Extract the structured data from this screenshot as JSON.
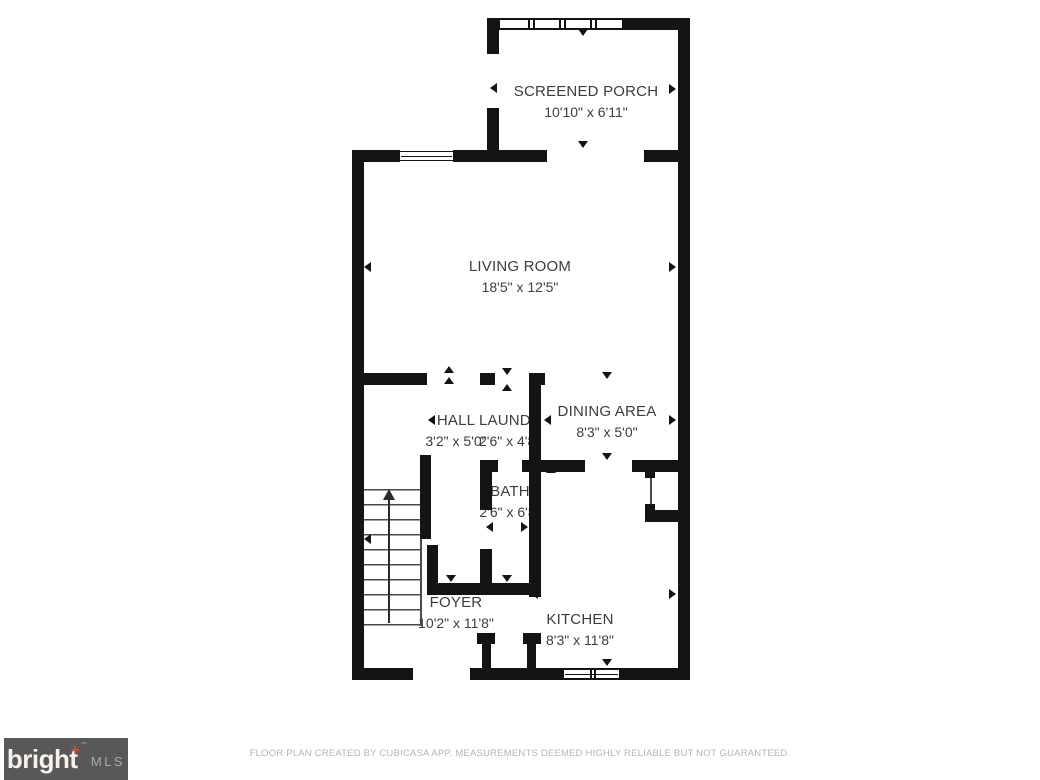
{
  "plan": {
    "rooms": [
      {
        "id": "screened-porch",
        "name": "SCREENED PORCH",
        "dims": "10'10\" x 6'11\""
      },
      {
        "id": "living-room",
        "name": "LIVING ROOM",
        "dims": "18'5\" x 12'5\""
      },
      {
        "id": "hall",
        "name": "HALL",
        "dims": "3'2\" x 5'0\""
      },
      {
        "id": "laundry",
        "name": "LAUNDRY",
        "dims": "2'6\" x 4'8\""
      },
      {
        "id": "dining-area",
        "name": "DINING AREA",
        "dims": "8'3\" x 5'0\""
      },
      {
        "id": "bath",
        "name": "BATH",
        "dims": "2'6\" x 6'8\""
      },
      {
        "id": "foyer",
        "name": "FOYER",
        "dims": "10'2\" x 11'8\""
      },
      {
        "id": "kitchen",
        "name": "KITCHEN",
        "dims": "8'3\" x 11'8\""
      }
    ],
    "stairs_direction": "up"
  },
  "footer": {
    "disclaimer": "FLOOR PLAN CREATED BY CUBICASA APP. MEASUREMENTS DEEMED HIGHLY RELIABLE BUT NOT GUARANTEED."
  },
  "logo": {
    "brand": "bright",
    "plus": "+",
    "tm": "™",
    "suffix": "MLS"
  },
  "colors": {
    "wall": "#141414",
    "label_text": "#3d3d3d",
    "footer_text": "#b5b5b5",
    "logo_bg": "#58585a",
    "logo_text": "#f7f2e9",
    "logo_plus": "#d24f28"
  }
}
